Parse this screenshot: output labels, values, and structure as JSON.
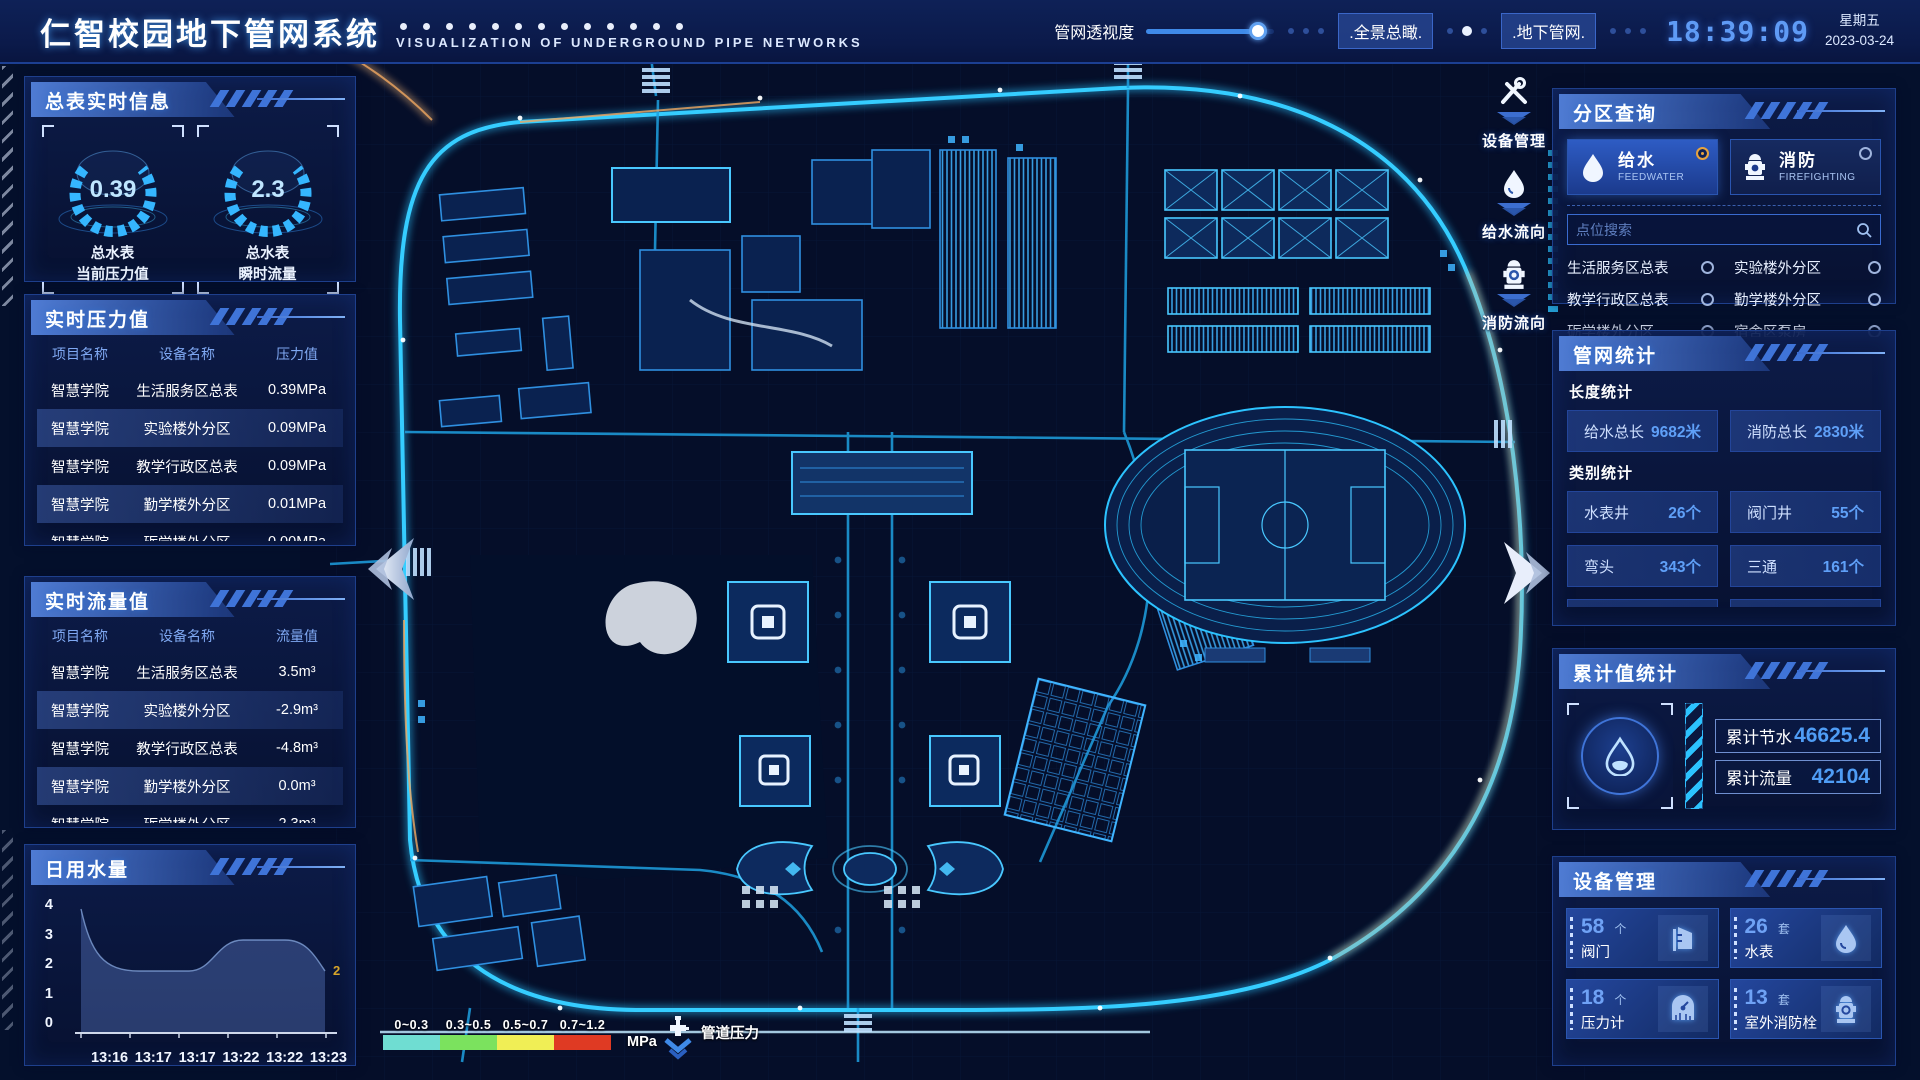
{
  "colors": {
    "accent": "#2cc3ff",
    "selected_radio": "#e8a33d",
    "value_blue": "#4f9df5"
  },
  "header": {
    "title": "仁智校园地下管网系统",
    "subtitle": "VISUALIZATION OF UNDERGROUND PIPE NETWORKS",
    "slider_label": "管网透视度",
    "btn_overview": ".全景总瞰.",
    "btn_underground": ".地下管网.",
    "clock": "18:39:09",
    "weekday": "星期五",
    "date": "2023-03-24"
  },
  "left": {
    "meters": {
      "title": "总表实时信息",
      "gauges": [
        {
          "value": "0.39",
          "label1": "总水表",
          "label2": "当前压力值"
        },
        {
          "value": "2.3",
          "label1": "总水表",
          "label2": "瞬时流量"
        }
      ]
    },
    "pressure": {
      "title": "实时压力值",
      "headers": [
        "项目名称",
        "设备名称",
        "压力值"
      ],
      "rows": [
        [
          "智慧学院",
          "生活服务区总表",
          "0.39MPa"
        ],
        [
          "智慧学院",
          "实验楼外分区",
          "0.09MPa"
        ],
        [
          "智慧学院",
          "教学行政区总表",
          "0.09MPa"
        ],
        [
          "智慧学院",
          "勤学楼外分区",
          "0.01MPa"
        ],
        [
          "智慧学院",
          "砺学楼外分区",
          "0.00MPa"
        ]
      ]
    },
    "flow": {
      "title": "实时流量值",
      "headers": [
        "项目名称",
        "设备名称",
        "流量值"
      ],
      "rows": [
        [
          "智慧学院",
          "生活服务区总表",
          "3.5m³"
        ],
        [
          "智慧学院",
          "实验楼外分区",
          "-2.9m³"
        ],
        [
          "智慧学院",
          "教学行政区总表",
          "-4.8m³"
        ],
        [
          "智慧学院",
          "勤学楼外分区",
          "0.0m³"
        ],
        [
          "智慧学院",
          "砺学楼外分区",
          "2.3m³"
        ]
      ]
    },
    "daily": {
      "title": "日用水量"
    }
  },
  "chart_data": {
    "type": "area",
    "title": "日用水量",
    "x": [
      "13:16",
      "13:17",
      "13:17",
      "13:22",
      "13:22",
      "13:23"
    ],
    "values": [
      4,
      2,
      2,
      3,
      3,
      2
    ],
    "yticks": [
      "4",
      "3",
      "2",
      "1",
      "0"
    ],
    "ylim": [
      0,
      4
    ],
    "end_label": "2",
    "legend_position": "none",
    "grid": false
  },
  "right": {
    "query": {
      "title": "分区查询",
      "tabs": [
        {
          "label": "给水",
          "sub": "FEEDWATER",
          "selected": true
        },
        {
          "label": "消防",
          "sub": "FIREFIGHTING",
          "selected": false
        }
      ],
      "search_placeholder": "点位搜索",
      "points": [
        "生活服务区总表",
        "实验楼外分区",
        "教学行政区总表",
        "勤学楼外分区",
        "砺学楼外分区",
        "宿舍区泵房"
      ]
    },
    "stats": {
      "title": "管网统计",
      "length_label": "长度统计",
      "length_items": [
        {
          "label": "给水总长",
          "value": "9682米"
        },
        {
          "label": "消防总长",
          "value": "2830米"
        }
      ],
      "cat_label": "类别统计",
      "cat_items": [
        {
          "label": "水表井",
          "value": "26个"
        },
        {
          "label": "阀门井",
          "value": "55个"
        },
        {
          "label": "弯头",
          "value": "343个"
        },
        {
          "label": "三通",
          "value": "161个"
        }
      ]
    },
    "totals": {
      "title": "累计值统计",
      "items": [
        {
          "label": "累计节水",
          "value": "46625.4"
        },
        {
          "label": "累计流量",
          "value": "42104"
        }
      ]
    },
    "devices": {
      "title": "设备管理",
      "cards": [
        {
          "count": "58",
          "unit": "个",
          "label": "阀门",
          "icon": "valve-icon"
        },
        {
          "count": "26",
          "unit": "套",
          "label": "水表",
          "icon": "water-drop-icon"
        },
        {
          "count": "18",
          "unit": "个",
          "label": "压力计",
          "icon": "pressure-gauge-icon"
        },
        {
          "count": "13",
          "unit": "套",
          "label": "室外消防栓",
          "icon": "hydrant-icon"
        }
      ]
    }
  },
  "map_toolbar": [
    {
      "label": "设备管理",
      "icon": "tools-icon"
    },
    {
      "label": "给水流向",
      "icon": "water-drop-icon"
    },
    {
      "label": "消防流向",
      "icon": "hydrant-icon"
    }
  ],
  "legend": {
    "ranges": [
      {
        "label": "0~0.3",
        "color": "#6fddd2"
      },
      {
        "label": "0.3~0.5",
        "color": "#7be25e"
      },
      {
        "label": "0.5~0.7",
        "color": "#f0ee55"
      },
      {
        "label": "0.7~1.2",
        "color": "#df3a23"
      }
    ],
    "unit": "MPa",
    "pipe_label": "管道压力"
  }
}
